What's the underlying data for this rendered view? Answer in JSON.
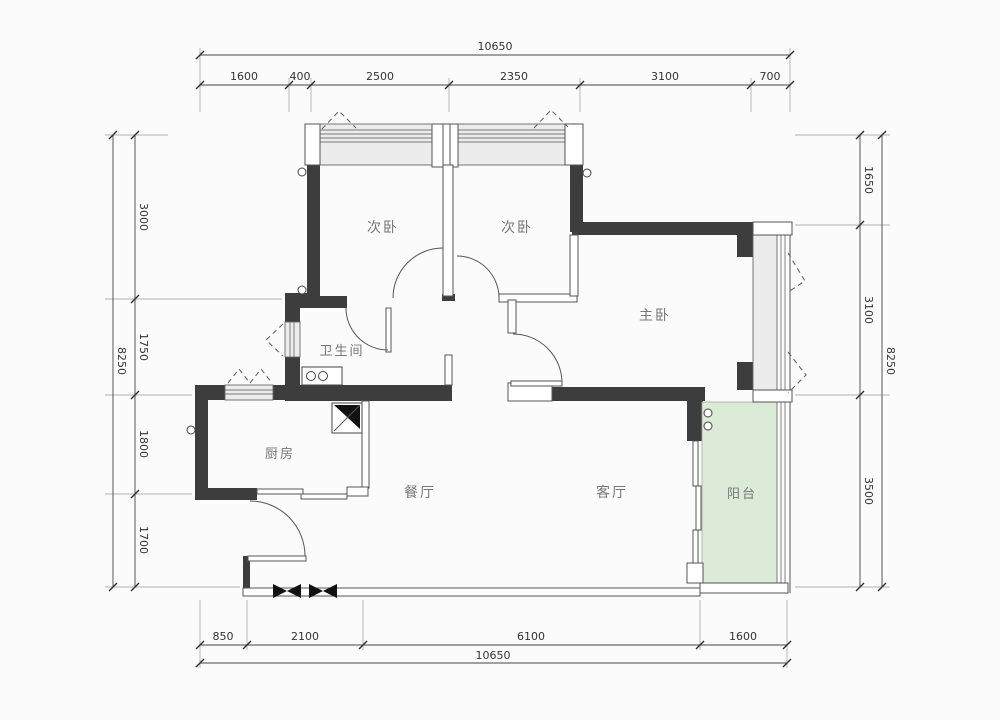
{
  "meta": {
    "drawing_type": "apartment-floor-plan"
  },
  "colors": {
    "background": "#fbfbfb",
    "wall": "#3d3d3d",
    "thin_line": "#555555",
    "window_fill": "#ececec",
    "balcony_fill": "#dcead8",
    "dimension_text": "#333333",
    "room_text": "#777777"
  },
  "rooms": [
    {
      "name": "bedroom-left",
      "label": "次卧"
    },
    {
      "name": "bedroom-right",
      "label": "次卧"
    },
    {
      "name": "master-bedroom",
      "label": "主卧"
    },
    {
      "name": "bathroom",
      "label": "卫生间"
    },
    {
      "name": "kitchen",
      "label": "厨房"
    },
    {
      "name": "dining-room",
      "label": "餐厅"
    },
    {
      "name": "living-room",
      "label": "客厅"
    },
    {
      "name": "balcony",
      "label": "阳台"
    }
  ],
  "dimensions": {
    "top": {
      "total": "10650",
      "segments": [
        "1600",
        "400",
        "2500",
        "2350",
        "3100",
        "700"
      ]
    },
    "bottom": {
      "total": "10650",
      "segments": [
        "850",
        "2100",
        "6100",
        "1600"
      ]
    },
    "left": {
      "total": "8250",
      "segments": [
        "3000",
        "1750",
        "1800",
        "1700"
      ]
    },
    "right": {
      "total": "8250",
      "segments": [
        "1650",
        "3100",
        "3500"
      ]
    }
  },
  "symbols": {
    "flue": "kitchen-flue-duct",
    "sink": "bathroom-double-basin",
    "drains": "balcony-floor-drains",
    "entry_marks": "entry-threshold-marks",
    "wall_circles": "pipe-point-markers"
  }
}
